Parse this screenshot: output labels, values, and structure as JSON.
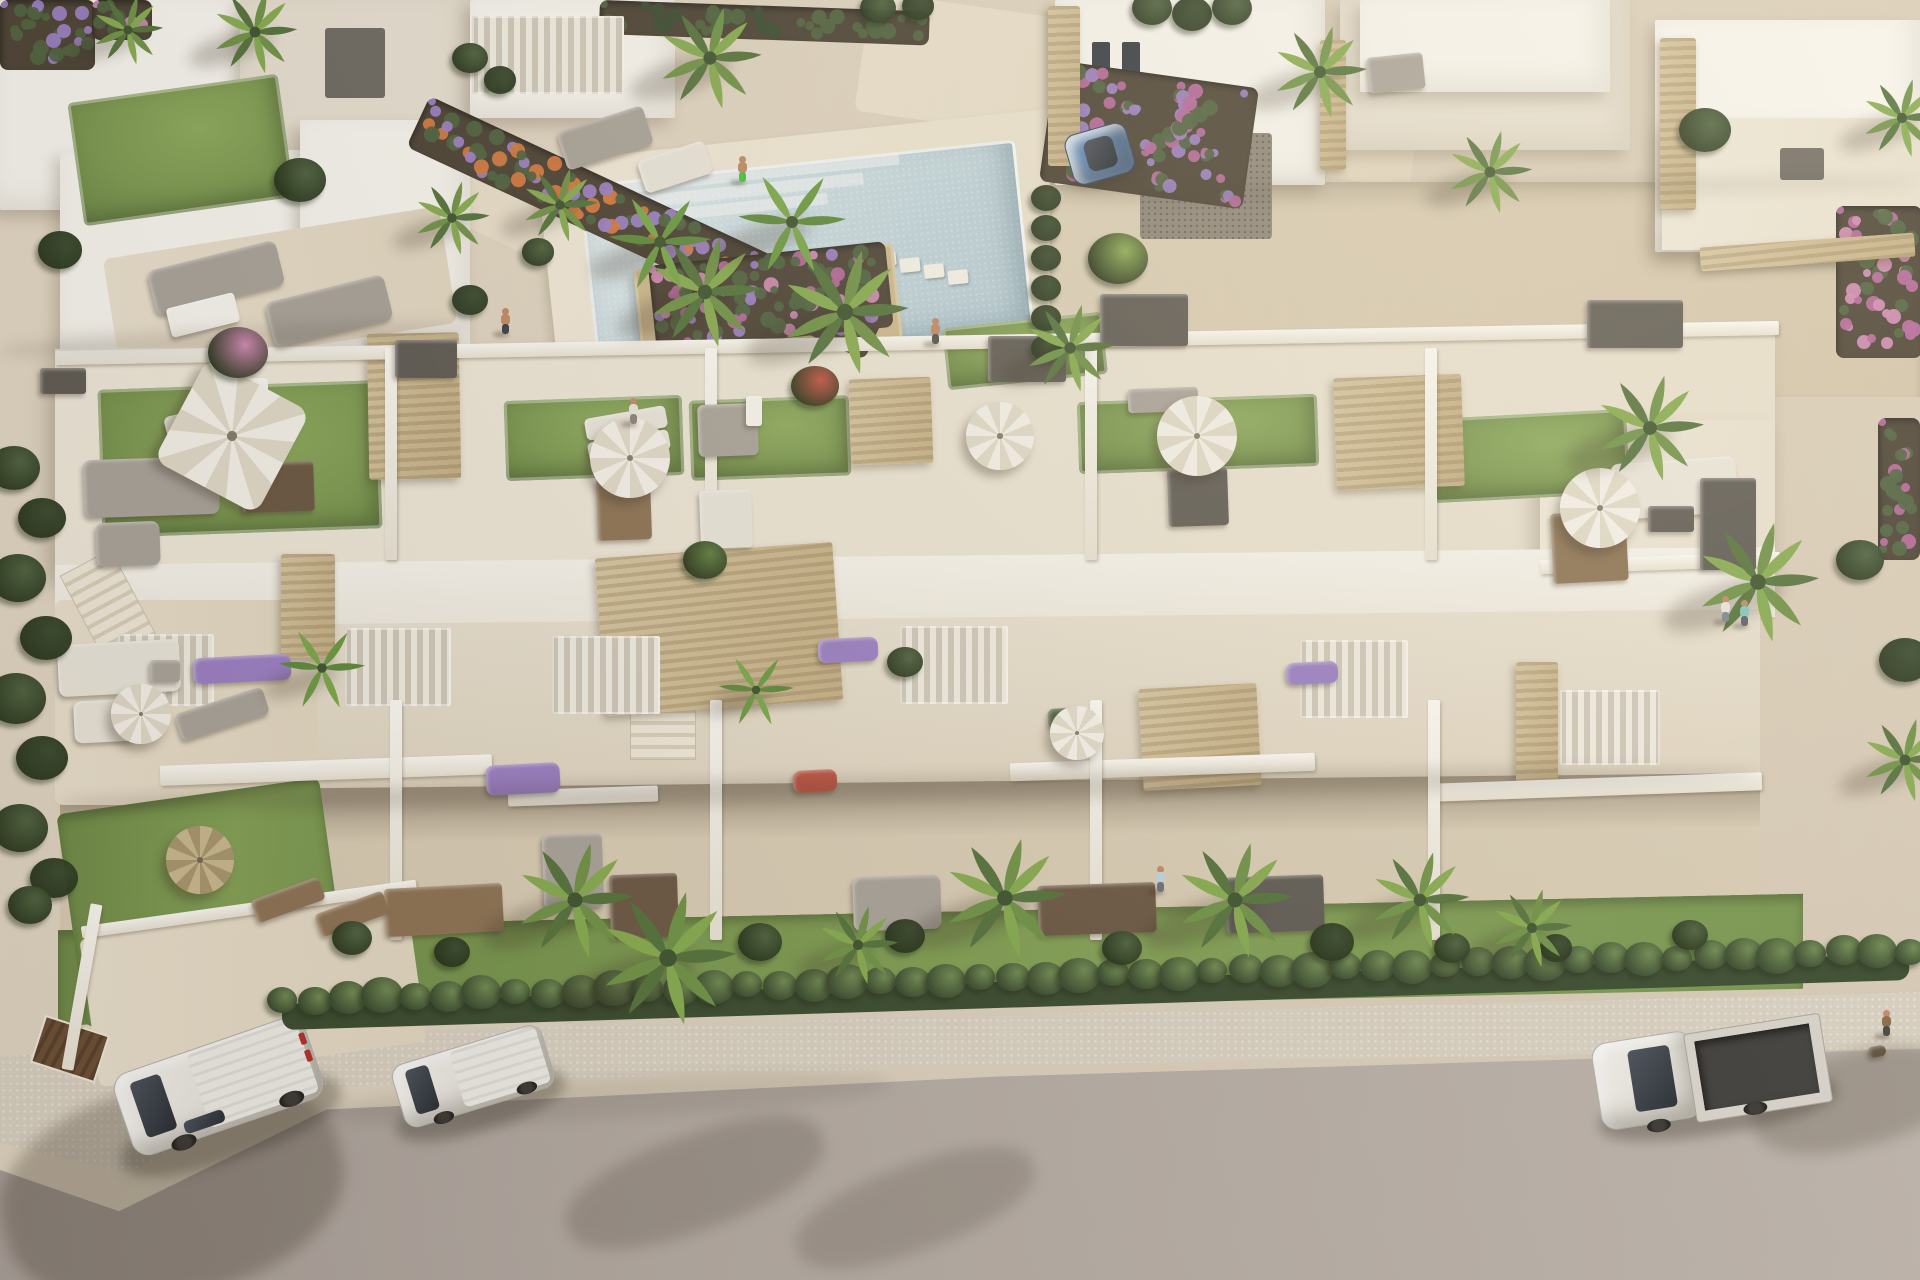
{
  "palette": {
    "pavement": "#ddd3c1",
    "pavement_light": "#eae2d2",
    "wall_white": "#f7f5ef",
    "wall_shade": "#e6dfd1",
    "wall_dark": "#cfc9bc",
    "roof_deck": "#ece5d6",
    "turf": "#7d9a52",
    "turf_dark": "#6c8847",
    "lawn": "#7c9b52",
    "hedge": "#4e6340",
    "hedge_dark": "#3a4c30",
    "palm": "#5f7d40",
    "palm_light": "#8fae57",
    "soil": "#4c4336",
    "flower_purple": "#9b7fc4",
    "flower_pink": "#cf8ab4",
    "flower_magenta": "#b5679c",
    "flower_orange": "#d4793f",
    "flower_red": "#c05543",
    "pool_water": "#bfd3dc",
    "pool_light": "#dde9ec",
    "pool_deck": "#efe7d8",
    "stone": "#c9b48c",
    "wood": "#8d7355",
    "wood_dark": "#6b5844",
    "furn_gray": "#a9a39a",
    "furn_dark": "#5f5b54",
    "furn_light": "#e9e5da",
    "road": "#b2a9a2",
    "sidewalk": "#d8d0c1",
    "car_white": "#eceae6",
    "car_blue": "#5b82b4",
    "glass_dark": "#333a42",
    "umbrella_white": "#f4f1ea",
    "umbrella_straw": "#c9b98f",
    "skin": "#c08a66",
    "shadow": "rgba(55,45,32,0.3)"
  },
  "scene": {
    "turf": [
      [
        100,
        385,
        280,
        148,
        -2
      ],
      [
        505,
        398,
        178,
        80,
        -2
      ],
      [
        690,
        398,
        160,
        80,
        -2
      ],
      [
        1078,
        398,
        240,
        72,
        -2
      ],
      [
        1432,
        414,
        196,
        84,
        -3
      ],
      [
        945,
        320,
        160,
        62,
        -6
      ],
      [
        75,
        88,
        212,
        124,
        -8
      ]
    ],
    "beds": [
      [
        430,
        96,
        505,
        56,
        25,
        [
          "flower_purple",
          "flower_orange",
          "hedge"
        ]
      ],
      [
        648,
        266,
        238,
        86,
        -6,
        [
          "flower_pink",
          "flower_magenta",
          "flower_purple",
          "hedge"
        ]
      ],
      [
        1056,
        60,
        205,
        122,
        8,
        [
          "flower_purple",
          "flower_magenta",
          "hedge"
        ]
      ],
      [
        0,
        0,
        95,
        70,
        0,
        [
          "flower_purple",
          "hedge"
        ]
      ],
      [
        92,
        0,
        60,
        40,
        0,
        [
          "flower_pink",
          "hedge"
        ]
      ],
      [
        1836,
        206,
        86,
        152,
        0,
        [
          "flower_magenta",
          "flower_pink"
        ]
      ],
      [
        1878,
        418,
        42,
        142,
        0,
        [
          "flower_magenta",
          "hedge"
        ]
      ],
      [
        600,
        0,
        330,
        34,
        2,
        [
          "hedge",
          "hedge_dark"
        ]
      ]
    ],
    "stone": [
      [
        600,
        550,
        238,
        158,
        -4
      ],
      [
        281,
        554,
        54,
        104,
        0
      ],
      [
        1141,
        686,
        118,
        102,
        -3
      ],
      [
        1516,
        662,
        42,
        124,
        0
      ],
      [
        368,
        333,
        92,
        146,
        -1
      ],
      [
        850,
        378,
        82,
        86,
        -2
      ],
      [
        1335,
        376,
        128,
        112,
        -2
      ],
      [
        1048,
        6,
        32,
        160,
        0
      ],
      [
        1320,
        40,
        26,
        130,
        0
      ],
      [
        1660,
        38,
        36,
        172,
        0
      ],
      [
        1700,
        240,
        215,
        24,
        -4
      ]
    ],
    "slats": [
      [
        345,
        628,
        106,
        78
      ],
      [
        552,
        636,
        108,
        78
      ],
      [
        900,
        626,
        108,
        78
      ],
      [
        1300,
        640,
        108,
        78
      ],
      [
        118,
        634,
        96,
        72
      ],
      [
        472,
        16,
        152,
        78
      ],
      [
        1560,
        690,
        100,
        75
      ]
    ],
    "walls": [
      [
        55,
        336,
        1724,
        14,
        -1
      ],
      [
        385,
        348,
        12,
        212,
        0
      ],
      [
        705,
        348,
        12,
        212,
        0
      ],
      [
        1085,
        348,
        12,
        212,
        0
      ],
      [
        1425,
        348,
        12,
        212,
        0
      ],
      [
        1540,
        556,
        240,
        14,
        -2
      ],
      [
        160,
        760,
        332,
        20,
        -2
      ],
      [
        1010,
        758,
        305,
        18,
        -2
      ],
      [
        1430,
        778,
        332,
        18,
        -2
      ],
      [
        508,
        788,
        150,
        16,
        -2
      ],
      [
        390,
        700,
        12,
        240,
        0
      ],
      [
        710,
        700,
        12,
        240,
        0
      ],
      [
        1090,
        700,
        12,
        240,
        0
      ],
      [
        1428,
        700,
        12,
        240,
        0
      ],
      [
        80,
        903,
        338,
        12,
        -8
      ],
      [
        76,
        903,
        12,
        168,
        10
      ]
    ],
    "furniture": [
      [
        165,
        408,
        78,
        26,
        -14,
        "furn_light",
        6
      ],
      [
        208,
        434,
        78,
        26,
        -14,
        "furn_light",
        6
      ],
      [
        242,
        462,
        72,
        50,
        -2,
        "wood_dark",
        4
      ],
      [
        84,
        458,
        135,
        58,
        -2,
        "furn_gray",
        8
      ],
      [
        96,
        522,
        64,
        44,
        -2,
        "furn_gray",
        8
      ],
      [
        232,
        378,
        36,
        26,
        0,
        "wall_white",
        4
      ],
      [
        585,
        412,
        82,
        22,
        -10,
        "furn_light",
        5
      ],
      [
        588,
        436,
        82,
        20,
        -10,
        "furn_light",
        5
      ],
      [
        597,
        478,
        54,
        62,
        -2,
        "wood",
        4
      ],
      [
        698,
        404,
        60,
        52,
        -2,
        "furn_gray",
        6
      ],
      [
        746,
        396,
        16,
        30,
        0,
        "wall_white",
        3
      ],
      [
        700,
        490,
        52,
        58,
        -2,
        "furn_light",
        4
      ],
      [
        1128,
        388,
        70,
        24,
        -2,
        "furn_gray",
        4
      ],
      [
        1168,
        468,
        60,
        58,
        -2,
        "furn_dark",
        4
      ],
      [
        1612,
        460,
        125,
        56,
        -4,
        "furn_light",
        8
      ],
      [
        1648,
        506,
        46,
        26,
        0,
        "furn_dark",
        3
      ],
      [
        1552,
        512,
        75,
        70,
        -3,
        "wood",
        4
      ],
      [
        395,
        340,
        62,
        38,
        0,
        "furn_dark",
        3
      ],
      [
        988,
        336,
        78,
        46,
        0,
        "furn_dark",
        3
      ],
      [
        1100,
        294,
        88,
        52,
        0,
        "furn_dark",
        3
      ],
      [
        1587,
        300,
        96,
        48,
        0,
        "furn_dark",
        3
      ],
      [
        1700,
        478,
        56,
        92,
        0,
        "furn_dark",
        3
      ],
      [
        40,
        368,
        46,
        26,
        0,
        "furn_dark",
        3
      ],
      [
        193,
        656,
        98,
        26,
        -3,
        "flower_purple",
        8
      ],
      [
        486,
        764,
        74,
        30,
        -3,
        "flower_purple",
        8
      ],
      [
        818,
        638,
        60,
        24,
        -3,
        "flower_purple",
        8
      ],
      [
        793,
        770,
        44,
        22,
        -3,
        "flower_red",
        8
      ],
      [
        1286,
        662,
        52,
        22,
        -3,
        "flower_purple",
        8
      ],
      [
        1048,
        708,
        40,
        20,
        -3,
        "hedge",
        6
      ],
      [
        385,
        886,
        118,
        48,
        -3,
        "wood",
        4
      ],
      [
        610,
        874,
        68,
        64,
        -2,
        "wood_dark",
        4
      ],
      [
        853,
        876,
        88,
        54,
        -2,
        "furn_gray",
        8
      ],
      [
        1038,
        884,
        118,
        50,
        -2,
        "wood_dark",
        4
      ],
      [
        1226,
        876,
        98,
        56,
        -2,
        "furn_dark",
        4
      ],
      [
        543,
        834,
        60,
        74,
        -2,
        "furn_gray",
        6
      ],
      [
        58,
        642,
        122,
        52,
        -3,
        "furn_light",
        8
      ],
      [
        74,
        700,
        64,
        42,
        -3,
        "furn_light",
        8
      ],
      [
        176,
        700,
        92,
        28,
        -18,
        "furn_gray",
        6
      ],
      [
        150,
        660,
        30,
        22,
        0,
        "furn_gray",
        4
      ],
      [
        252,
        888,
        72,
        24,
        -20,
        "wood",
        5
      ],
      [
        316,
        902,
        72,
        24,
        -20,
        "wood",
        5
      ],
      [
        150,
        255,
        132,
        46,
        -14,
        "furn_gray",
        8
      ],
      [
        268,
        288,
        122,
        46,
        -14,
        "furn_gray",
        8
      ],
      [
        168,
        300,
        70,
        30,
        -14,
        "wall_white",
        4
      ],
      [
        560,
        118,
        90,
        40,
        -18,
        "furn_gray",
        6
      ],
      [
        640,
        150,
        70,
        34,
        -18,
        "furn_light",
        6
      ],
      [
        1368,
        55,
        56,
        36,
        -6,
        "furn_gray",
        4
      ],
      [
        1868,
        1046,
        18,
        11,
        -10,
        "wood_dark",
        6
      ]
    ],
    "umbrellas": [
      [
        232,
        436,
        58,
        "square"
      ],
      [
        630,
        458,
        40,
        "white"
      ],
      [
        1000,
        436,
        34,
        "white"
      ],
      [
        1197,
        436,
        40,
        "white"
      ],
      [
        1600,
        508,
        40,
        "white"
      ],
      [
        141,
        714,
        30,
        "white"
      ],
      [
        1077,
        733,
        27,
        "white"
      ],
      [
        200,
        860,
        34,
        "straw"
      ]
    ],
    "palms": [
      [
        575,
        900,
        1.25,
        "palm"
      ],
      [
        668,
        958,
        1.45,
        "palm"
      ],
      [
        858,
        945,
        0.85,
        "palm"
      ],
      [
        1005,
        898,
        1.3,
        "palm"
      ],
      [
        1235,
        900,
        1.25,
        "palm"
      ],
      [
        1420,
        900,
        1.05,
        "palm"
      ],
      [
        1532,
        928,
        0.85,
        "palm"
      ],
      [
        705,
        292,
        1.2,
        "palm"
      ],
      [
        845,
        312,
        1.35,
        "palm"
      ],
      [
        1070,
        348,
        0.95,
        "palm"
      ],
      [
        660,
        242,
        0.95,
        "banana"
      ],
      [
        792,
        222,
        1.0,
        "banana"
      ],
      [
        560,
        205,
        0.8,
        "palm"
      ],
      [
        710,
        58,
        1.1,
        "palm"
      ],
      [
        1320,
        72,
        1.0,
        "palm"
      ],
      [
        1490,
        172,
        0.9,
        "palm"
      ],
      [
        1650,
        428,
        1.15,
        "palm"
      ],
      [
        1758,
        582,
        1.3,
        "palm"
      ],
      [
        1902,
        118,
        0.85,
        "palm"
      ],
      [
        1905,
        760,
        0.9,
        "palm"
      ],
      [
        255,
        32,
        0.9,
        "palm"
      ],
      [
        128,
        30,
        0.75,
        "palm"
      ],
      [
        452,
        218,
        0.8,
        "palm"
      ],
      [
        322,
        668,
        0.8,
        "banana"
      ],
      [
        756,
        690,
        0.7,
        "banana"
      ]
    ],
    "hedge_row": {
      "x1": 282,
      "y1": 1000,
      "x2": 1910,
      "y2": 950,
      "count": 50
    },
    "bushes": [
      [
        14,
        468,
        26,
        "hedge"
      ],
      [
        42,
        518,
        24,
        "hedge_dark"
      ],
      [
        18,
        578,
        28,
        "hedge"
      ],
      [
        46,
        638,
        26,
        "hedge_dark"
      ],
      [
        16,
        698,
        30,
        "hedge"
      ],
      [
        42,
        758,
        26,
        "hedge_dark"
      ],
      [
        20,
        828,
        28,
        "hedge"
      ],
      [
        54,
        878,
        24,
        "hedge_dark"
      ],
      [
        30,
        905,
        22,
        "hedge"
      ],
      [
        352,
        938,
        20,
        "hedge"
      ],
      [
        452,
        952,
        18,
        "hedge_dark"
      ],
      [
        760,
        942,
        22,
        "hedge"
      ],
      [
        905,
        936,
        20,
        "hedge_dark"
      ],
      [
        1122,
        948,
        20,
        "hedge"
      ],
      [
        1332,
        942,
        22,
        "hedge_dark"
      ],
      [
        1452,
        948,
        18,
        "hedge"
      ],
      [
        1556,
        948,
        16,
        "hedge_dark"
      ],
      [
        1690,
        935,
        18,
        "hedge"
      ],
      [
        470,
        58,
        18,
        "hedge"
      ],
      [
        500,
        80,
        16,
        "hedge_dark"
      ],
      [
        538,
        252,
        16,
        "hedge"
      ],
      [
        470,
        300,
        18,
        "hedge_dark"
      ],
      [
        1046,
        198,
        15,
        "hedge_dark"
      ],
      [
        1046,
        228,
        15,
        "hedge_dark"
      ],
      [
        1046,
        258,
        15,
        "hedge_dark"
      ],
      [
        1046,
        288,
        15,
        "hedge_dark"
      ],
      [
        1046,
        318,
        15,
        "hedge_dark"
      ],
      [
        1046,
        348,
        15,
        "hedge_dark"
      ],
      [
        1152,
        8,
        20,
        "hedge"
      ],
      [
        1192,
        14,
        20,
        "hedge_dark"
      ],
      [
        1232,
        8,
        20,
        "hedge"
      ],
      [
        878,
        8,
        18,
        "hedge"
      ],
      [
        918,
        6,
        16,
        "hedge_dark"
      ],
      [
        238,
        352,
        30,
        "flower_pink"
      ],
      [
        815,
        386,
        24,
        "flower_red"
      ],
      [
        705,
        560,
        22,
        "palm"
      ],
      [
        905,
        662,
        18,
        "hedge"
      ],
      [
        1705,
        130,
        26,
        "hedge"
      ],
      [
        1860,
        560,
        24,
        "hedge"
      ],
      [
        1905,
        660,
        26,
        "hedge_dark"
      ],
      [
        300,
        180,
        26,
        "hedge"
      ],
      [
        60,
        250,
        22,
        "hedge_dark"
      ],
      [
        1118,
        258,
        30,
        "palm_light"
      ]
    ],
    "shadows": [
      [
        0,
        1085,
        345,
        210,
        -14,
        0.28
      ],
      [
        560,
        1135,
        270,
        95,
        -20,
        0.2
      ],
      [
        790,
        1165,
        250,
        85,
        -20,
        0.18
      ],
      [
        1750,
        1052,
        210,
        95,
        -14,
        0.22
      ],
      [
        60,
        776,
        1700,
        26,
        -1,
        0.16
      ],
      [
        0,
        328,
        470,
        22,
        -3,
        0.12
      ],
      [
        1055,
        180,
        860,
        18,
        -1,
        0.1
      ],
      [
        330,
        1078,
        560,
        40,
        -3,
        0.1
      ]
    ],
    "people": [
      {
        "x": 742,
        "y": 168,
        "top": "#c08a66",
        "bottom": "#49c23a"
      },
      {
        "x": 505,
        "y": 320,
        "top": "#c08a66",
        "bottom": "#3a3f46"
      },
      {
        "x": 633,
        "y": 410,
        "top": "#e8e4da",
        "bottom": "#8a8378"
      },
      {
        "x": 935,
        "y": 330,
        "top": "#c08a66",
        "bottom": "#555048"
      },
      {
        "x": 1725,
        "y": 608,
        "top": "#e8e4da",
        "bottom": "#7b8691"
      },
      {
        "x": 1744,
        "y": 612,
        "top": "#7fc7c0",
        "bottom": "#5b6066"
      },
      {
        "x": 1886,
        "y": 1022,
        "top": "#8a6a48",
        "bottom": "#4a4540"
      },
      {
        "x": 1160,
        "y": 878,
        "top": "#bcd4de",
        "bottom": "#6b7077"
      }
    ]
  }
}
